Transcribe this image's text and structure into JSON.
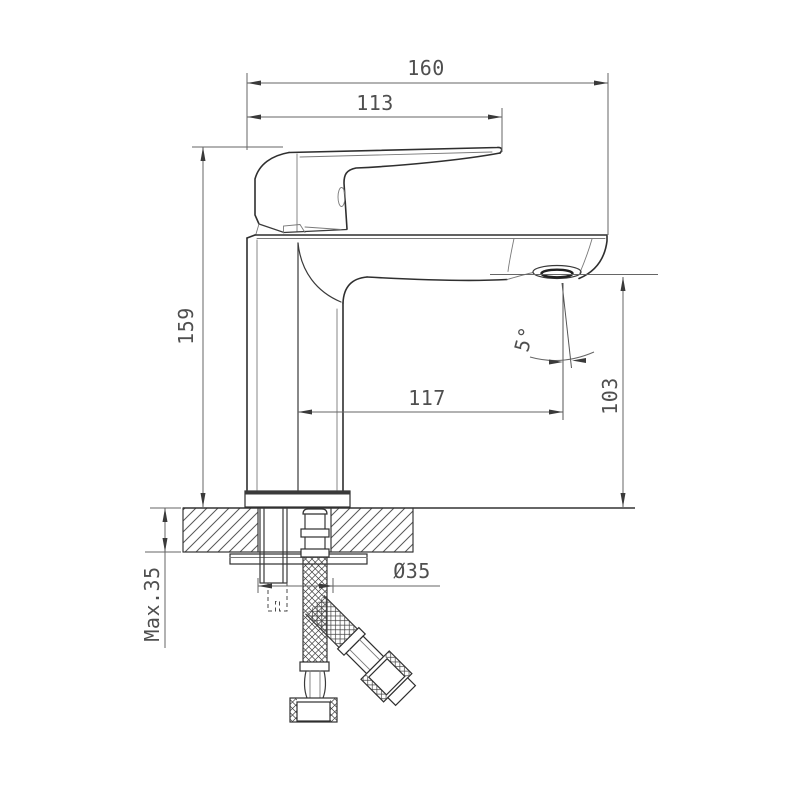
{
  "drawing": {
    "type": "technical-dimension-drawing",
    "subject": "single-lever basin mixer faucet, side view with mounting cross-section",
    "background": "#ffffff",
    "line_color": "#2f2f2f",
    "dim_color": "#666666",
    "text_color": "#4f4f4f",
    "dimensions": {
      "overall_width": "160",
      "handle_width": "113",
      "overall_height": "159",
      "spout_reach": "117",
      "spout_height": "103",
      "stream_angle": "5°",
      "mounting_hole_diameter": "Ø35",
      "max_counter_thickness": "Max.35"
    }
  }
}
